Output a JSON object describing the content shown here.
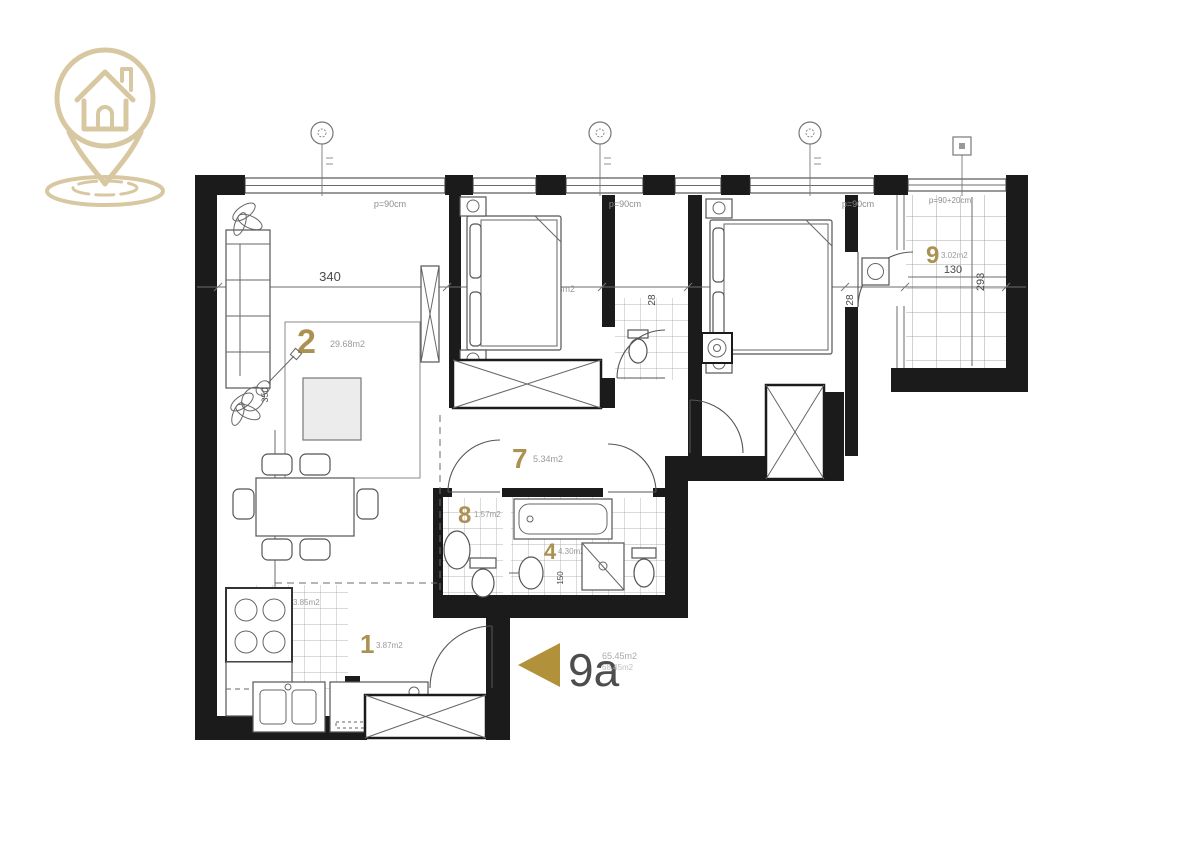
{
  "brand": {
    "logo_color": "#d8c8a2",
    "logo_name": "house-location-pin"
  },
  "unit": {
    "id": "9a",
    "area_net": "65.45m2",
    "area_gross": "68.45m2",
    "arrow_color": "#b2913b"
  },
  "rooms": [
    {
      "num": "1",
      "area": "3.87m2"
    },
    {
      "num": "2",
      "area": "29.68m2"
    },
    {
      "num": "3",
      "area": "3.85m2"
    },
    {
      "num": "4",
      "area": "4.30m2"
    },
    {
      "num": "5",
      "area": "10.43m2"
    },
    {
      "num": "6",
      "area": "11.79m2"
    },
    {
      "num": "7",
      "area": "5.34m2"
    },
    {
      "num": "8",
      "area": "1.57m2"
    },
    {
      "num": "9",
      "area": "3.02m2"
    }
  ],
  "dimensions": {
    "room2_width": "340",
    "room2_depth": "350",
    "room5_width": "343",
    "room6_width": "303",
    "terrace_width": "130",
    "terrace_depth": "293",
    "shaft_a": "28",
    "shaft_b": "28",
    "bath_dim": "150"
  },
  "window_labels": {
    "w1": "p=90cm",
    "w2": "p=90cm",
    "w3": "p=90cm",
    "terrace": "p=90+20cm"
  }
}
